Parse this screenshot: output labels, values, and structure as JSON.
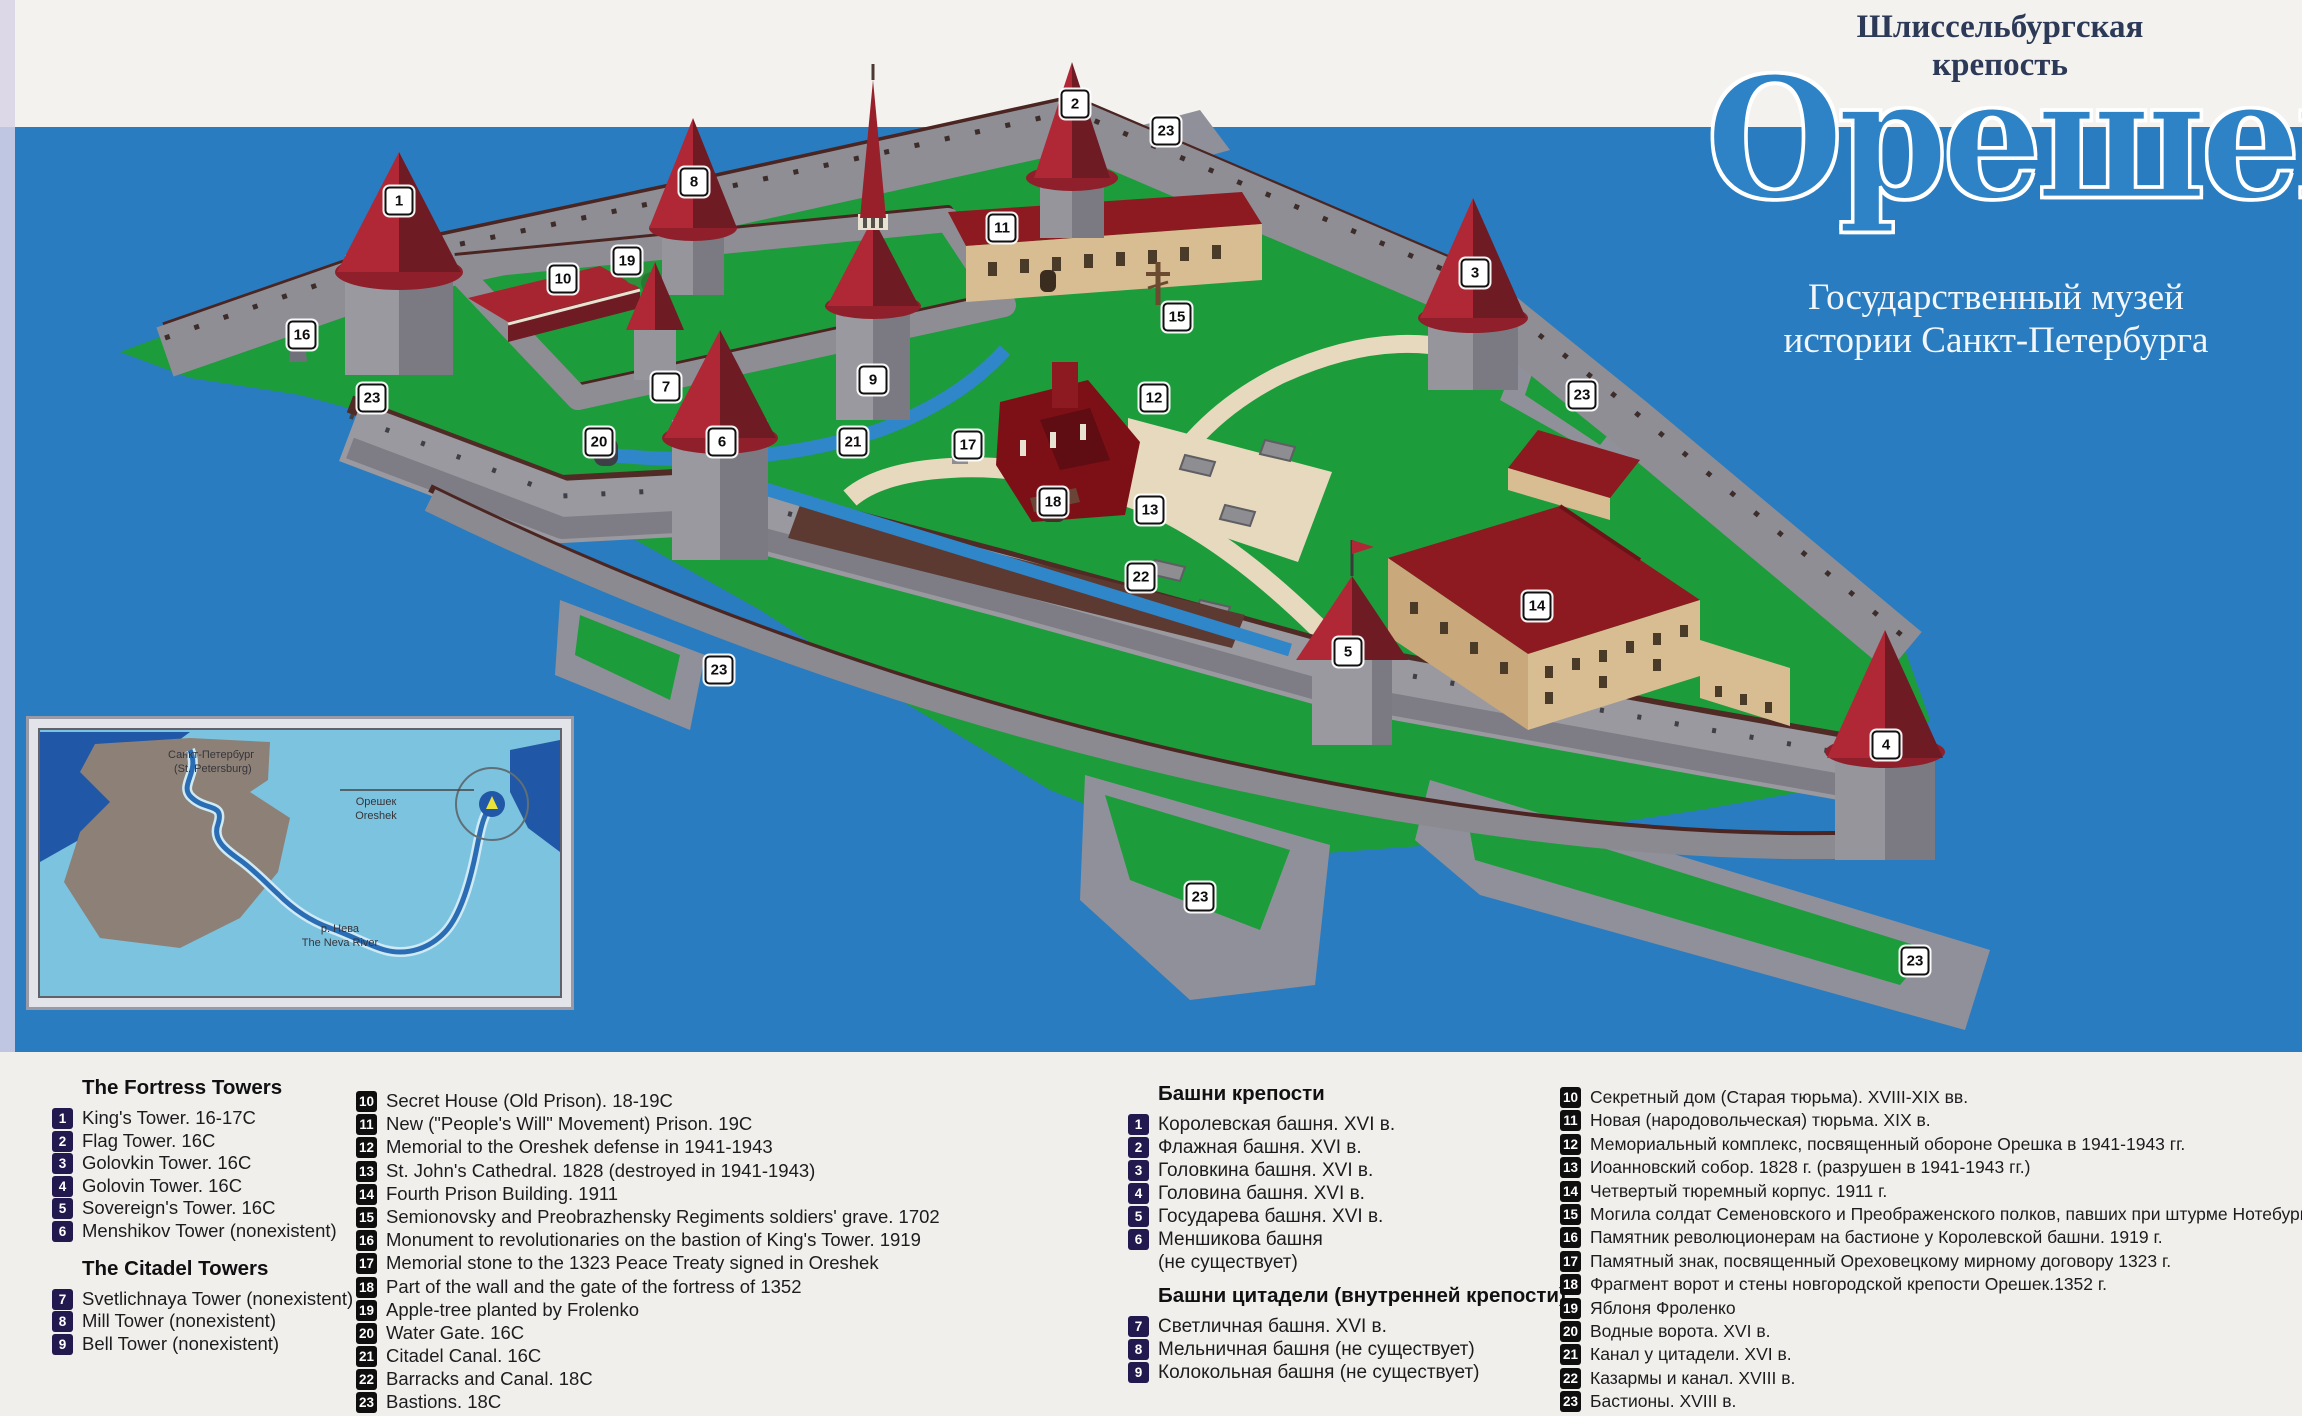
{
  "header": {
    "title_line1": "Шлиссельбургская",
    "title_line2": "крепость",
    "logo": "Орешек",
    "subtitle_line1": "Государственный музей",
    "subtitle_line2": "истории Санкт-Петербурга"
  },
  "colors": {
    "water": "#2a7cc0",
    "island_green": "#1d9c3b",
    "wall_gray": "#9a99a0",
    "wall_top_brown": "#4b2521",
    "roof_red": "#b02836",
    "roof_red_dark": "#6f1b24",
    "building_tan": "#d9bd92",
    "ruin_red": "#7d1016",
    "path_cream": "#e7d9bd",
    "legend_band": "#f1efec",
    "badge_navy": "#221a4e",
    "badge_black": "#0e0e0e",
    "logo_blue": "#2e83c6"
  },
  "map_markers": [
    {
      "n": "1",
      "x": 399,
      "y": 201
    },
    {
      "n": "2",
      "x": 1075,
      "y": 104
    },
    {
      "n": "3",
      "x": 1475,
      "y": 273
    },
    {
      "n": "4",
      "x": 1886,
      "y": 745
    },
    {
      "n": "5",
      "x": 1348,
      "y": 652
    },
    {
      "n": "6",
      "x": 722,
      "y": 442
    },
    {
      "n": "7",
      "x": 666,
      "y": 387
    },
    {
      "n": "8",
      "x": 694,
      "y": 182
    },
    {
      "n": "9",
      "x": 873,
      "y": 380
    },
    {
      "n": "10",
      "x": 563,
      "y": 279
    },
    {
      "n": "11",
      "x": 1002,
      "y": 228
    },
    {
      "n": "12",
      "x": 1154,
      "y": 398
    },
    {
      "n": "13",
      "x": 1150,
      "y": 510
    },
    {
      "n": "14",
      "x": 1537,
      "y": 606
    },
    {
      "n": "15",
      "x": 1177,
      "y": 317
    },
    {
      "n": "16",
      "x": 302,
      "y": 335
    },
    {
      "n": "17",
      "x": 968,
      "y": 445
    },
    {
      "n": "18",
      "x": 1053,
      "y": 502
    },
    {
      "n": "19",
      "x": 627,
      "y": 261
    },
    {
      "n": "20",
      "x": 599,
      "y": 442
    },
    {
      "n": "21",
      "x": 853,
      "y": 442
    },
    {
      "n": "22",
      "x": 1141,
      "y": 577
    },
    {
      "n": "23",
      "x": 1166,
      "y": 131
    },
    {
      "n": "23",
      "x": 372,
      "y": 398
    },
    {
      "n": "23",
      "x": 1582,
      "y": 395
    },
    {
      "n": "23",
      "x": 719,
      "y": 670
    },
    {
      "n": "23",
      "x": 1200,
      "y": 897
    },
    {
      "n": "23",
      "x": 1915,
      "y": 961
    }
  ],
  "inset": {
    "city_ru": "Санкт-Петербург",
    "city_en": "(St. Petersburg)",
    "fort_ru": "Орешек",
    "fort_en": "Oreshek",
    "river_ru": "р. Нева",
    "river_en": "The Neva River"
  },
  "legend_en": {
    "fortress_header": "The Fortress Towers",
    "fortress_items": [
      {
        "n": "1",
        "text": "King's Tower. 16-17C"
      },
      {
        "n": "2",
        "text": "Flag Tower. 16C"
      },
      {
        "n": "3",
        "text": "Golovkin Tower. 16C"
      },
      {
        "n": "4",
        "text": "Golovin Tower. 16C"
      },
      {
        "n": "5",
        "text": "Sovereign's Tower. 16C"
      },
      {
        "n": "6",
        "text": "Menshikov Tower (nonexistent)"
      }
    ],
    "citadel_header": "The Citadel Towers",
    "citadel_items": [
      {
        "n": "7",
        "text": "Svetlichnaya Tower (nonexistent)"
      },
      {
        "n": "8",
        "text": "Mill Tower (nonexistent)"
      },
      {
        "n": "9",
        "text": "Bell Tower (nonexistent)"
      }
    ],
    "numbered_items": [
      {
        "n": "10",
        "text": "Secret House (Old Prison). 18-19C"
      },
      {
        "n": "11",
        "text": "New (\"People's Will\" Movement) Prison. 19C"
      },
      {
        "n": "12",
        "text": "Memorial to the Oreshek defense in 1941-1943"
      },
      {
        "n": "13",
        "text": "St. John's Cathedral. 1828 (destroyed in 1941-1943)"
      },
      {
        "n": "14",
        "text": "Fourth Prison Building. 1911"
      },
      {
        "n": "15",
        "text": "Semionovsky and Preobrazhensky Regiments soldiers' grave. 1702"
      },
      {
        "n": "16",
        "text": "Monument to revolutionaries on the bastion of King's Tower. 1919"
      },
      {
        "n": "17",
        "text": "Memorial stone to the 1323 Peace Treaty signed in Oreshek"
      },
      {
        "n": "18",
        "text": "Part of the wall and the gate of the fortress of 1352"
      },
      {
        "n": "19",
        "text": "Apple-tree planted by Frolenko"
      },
      {
        "n": "20",
        "text": "Water Gate. 16C"
      },
      {
        "n": "21",
        "text": "Citadel Canal. 16C"
      },
      {
        "n": "22",
        "text": "Barracks and Canal. 18C"
      },
      {
        "n": "23",
        "text": "Bastions. 18C"
      }
    ]
  },
  "legend_ru": {
    "fortress_header": "Башни крепости",
    "fortress_items": [
      {
        "n": "1",
        "text": "Королевская башня. XVI в."
      },
      {
        "n": "2",
        "text": "Флажная башня. XVI в."
      },
      {
        "n": "3",
        "text": "Головкина башня. XVI в."
      },
      {
        "n": "4",
        "text": "Головина башня. XVI в."
      },
      {
        "n": "5",
        "text": "Государева башня. XVI в."
      },
      {
        "n": "6",
        "text": "Меншикова башня",
        "text2": "(не существует)"
      }
    ],
    "citadel_header": "Башни цитадели (внутренней крепости)",
    "citadel_items": [
      {
        "n": "7",
        "text": "Светличная башня. XVI в."
      },
      {
        "n": "8",
        "text": "Мельничная башня (не существует)"
      },
      {
        "n": "9",
        "text": "Колокольная башня (не существует)"
      }
    ],
    "numbered_items": [
      {
        "n": "10",
        "text": "Секретный дом (Старая тюрьма). XVIII-XIX вв."
      },
      {
        "n": "11",
        "text": "Новая (народовольческая) тюрьма. XIX в."
      },
      {
        "n": "12",
        "text": "Мемориальный комплекс, посвященный обороне Орешка в 1941-1943 гг."
      },
      {
        "n": "13",
        "text": "Иоанновский собор. 1828 г. (разрушен в 1941-1943 гг.)"
      },
      {
        "n": "14",
        "text": "Четвертый тюремный корпус. 1911 г."
      },
      {
        "n": "15",
        "text": "Могила солдат Семеновского и Преображенского полков, павших при штурме Нотебурга в 1702 г."
      },
      {
        "n": "16",
        "text": "Памятник революционерам на бастионе у Королевской башни. 1919 г."
      },
      {
        "n": "17",
        "text": "Памятный знак, посвященный Ореховецкому мирному договору 1323 г."
      },
      {
        "n": "18",
        "text": "Фрагмент ворот и стены новгородской крепости Орешек.1352 г."
      },
      {
        "n": "19",
        "text": "Яблоня Фроленко"
      },
      {
        "n": "20",
        "text": "Водные ворота. XVI в."
      },
      {
        "n": "21",
        "text": "Канал у цитадели. XVI в."
      },
      {
        "n": "22",
        "text": "Казармы и канал. XVIII в."
      },
      {
        "n": "23",
        "text": "Бастионы. XVIII в."
      }
    ]
  }
}
